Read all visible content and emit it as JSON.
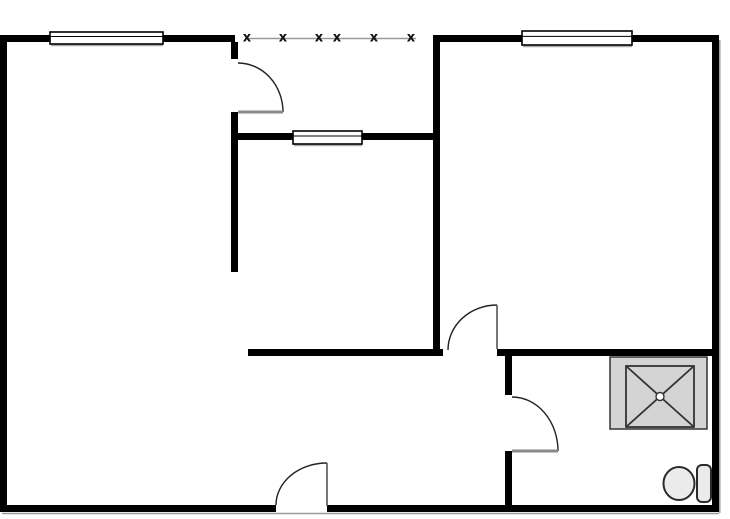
{
  "title": "two-room apartment floor plan",
  "canvas": {
    "width": 730,
    "height": 519,
    "bg": "#ffffff"
  },
  "style": {
    "wall_color": "#000000",
    "door_arc_color": "#222222",
    "door_leaf_color_gray": "#8a8a8a",
    "door_leaf_color_dark": "#555555",
    "window_fill": "#ffffff",
    "window_border": "#000000",
    "window_shadow": "#aaaaaa",
    "fence_line_color": "#999999",
    "fence_mark_color": "#111111",
    "fixture_fill": "#d4d4d4",
    "fixture_stroke": "#333333",
    "toilet_fill": "#ebebeb",
    "toilet_stroke": "#2a2a2a",
    "shadow_color": "#9a9a9a"
  },
  "plan": {
    "walls": [
      {
        "name": "wall-outer-top-left",
        "x": 0,
        "y": 35,
        "w": 235,
        "h": 7
      },
      {
        "name": "wall-outer-top-right",
        "x": 433,
        "y": 35,
        "w": 286,
        "h": 7
      },
      {
        "name": "wall-outer-left",
        "x": 0,
        "y": 35,
        "w": 7,
        "h": 477
      },
      {
        "name": "wall-outer-right",
        "x": 712,
        "y": 35,
        "w": 7,
        "h": 477
      },
      {
        "name": "wall-outer-bottom-left",
        "x": 0,
        "y": 505,
        "w": 276,
        "h": 7
      },
      {
        "name": "wall-outer-bottom-right",
        "x": 327,
        "y": 505,
        "w": 392,
        "h": 7
      },
      {
        "name": "wall-room1-door-stub",
        "x": 231,
        "y": 42,
        "w": 7,
        "h": 17
      },
      {
        "name": "wall-room1-right",
        "x": 231,
        "y": 112,
        "w": 7,
        "h": 160
      },
      {
        "name": "wall-interior-window",
        "x": 238,
        "y": 133,
        "w": 195,
        "h": 7
      },
      {
        "name": "wall-room2-left",
        "x": 433,
        "y": 42,
        "w": 7,
        "h": 310
      },
      {
        "name": "wall-hall-bottom-left",
        "x": 248,
        "y": 349,
        "w": 195,
        "h": 7
      },
      {
        "name": "wall-hall-bottom-right",
        "x": 497,
        "y": 349,
        "w": 215,
        "h": 7
      },
      {
        "name": "wall-bath-left-upper",
        "x": 505,
        "y": 356,
        "w": 7,
        "h": 39
      },
      {
        "name": "wall-bath-left-lower",
        "x": 505,
        "y": 451,
        "w": 7,
        "h": 54
      }
    ],
    "shadows": [
      {
        "name": "shadow-bottom-wall",
        "x1": 2,
        "y1": 513.5,
        "x2": 719,
        "y2": 513.5
      },
      {
        "name": "shadow-right-wall",
        "x1": 719.8,
        "y1": 40,
        "x2": 719.8,
        "y2": 513
      }
    ],
    "windows": [
      {
        "name": "window-room1-top",
        "x": 50,
        "y": 32,
        "w": 113,
        "h": 12,
        "inner_frac": 0.38
      },
      {
        "name": "window-interior",
        "x": 293,
        "y": 131,
        "w": 69,
        "h": 13,
        "inner_frac": 0.38
      },
      {
        "name": "window-room2-top",
        "x": 522,
        "y": 31,
        "w": 110,
        "h": 14,
        "inner_frac": 0.38
      }
    ],
    "doors": [
      {
        "name": "door-room1",
        "leaf": {
          "x1": 238,
          "y1": 112,
          "x2": 283,
          "y2": 112,
          "color": "#8a8a8a",
          "width": 3
        },
        "arc": "M 283 112 A 45 49 0 0 0 238 63"
      },
      {
        "name": "door-hall",
        "leaf": {
          "x1": 497,
          "y1": 305,
          "x2": 497,
          "y2": 349,
          "color": "#555555",
          "width": 1.6
        },
        "arc": "M 497 305 A 49 45 0 0 0 448 350"
      },
      {
        "name": "door-bathroom",
        "leaf": {
          "x1": 512,
          "y1": 451,
          "x2": 558,
          "y2": 451,
          "color": "#8a8a8a",
          "width": 3
        },
        "arc": "M 558 451 A 46 54 0 0 0 512 397"
      },
      {
        "name": "door-entry",
        "leaf": {
          "x1": 327,
          "y1": 463,
          "x2": 327,
          "y2": 506,
          "color": "#555555",
          "width": 1.6
        },
        "arc": "M 327 463 A 51 42 0 0 0 276 505"
      }
    ],
    "fence": {
      "name": "balcony-railing",
      "line": {
        "x1": 249,
        "y1": 38.5,
        "x2": 416,
        "y2": 38.5
      },
      "mark_symbol": "x",
      "mark_y": 38,
      "mark_font_size": 13,
      "mark_xs": [
        247,
        283,
        319,
        337,
        374,
        411
      ]
    },
    "fixtures": {
      "shower": {
        "name": "shower-tray",
        "outer": {
          "x": 610,
          "y": 357,
          "w": 97,
          "h": 72
        },
        "inner": {
          "x": 626,
          "y": 366,
          "w": 68,
          "h": 61
        },
        "drain": {
          "cx": 660,
          "cy": 396.5,
          "r": 4
        }
      },
      "toilet": {
        "name": "toilet",
        "bowl": {
          "cx": 679,
          "cy": 483.5,
          "rx": 15.5,
          "ry": 16.5
        },
        "tank": {
          "x": 697,
          "y": 465,
          "w": 14,
          "h": 37,
          "rx": 5
        }
      }
    }
  }
}
